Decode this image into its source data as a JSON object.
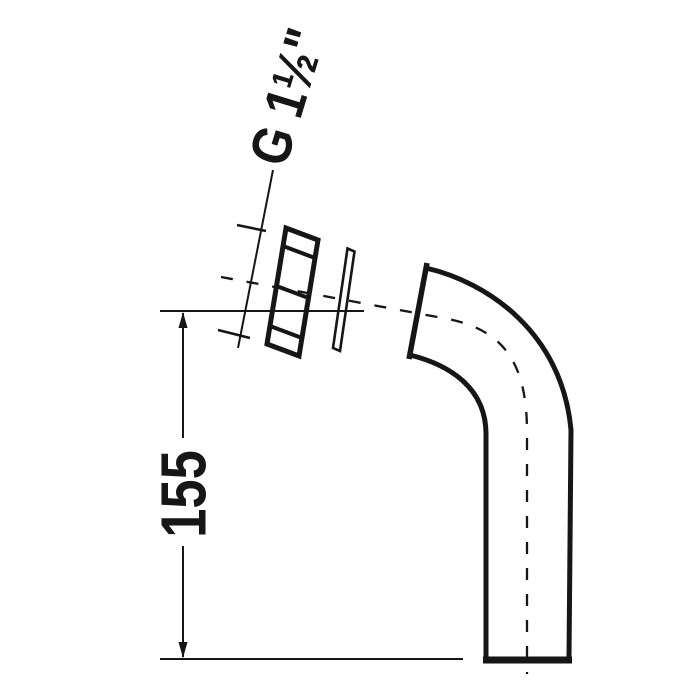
{
  "colors": {
    "ink": "#161616",
    "background": "#ffffff"
  },
  "drawing": {
    "labels": {
      "thread_size": "G 1½\"",
      "height_dimension": "155"
    }
  }
}
